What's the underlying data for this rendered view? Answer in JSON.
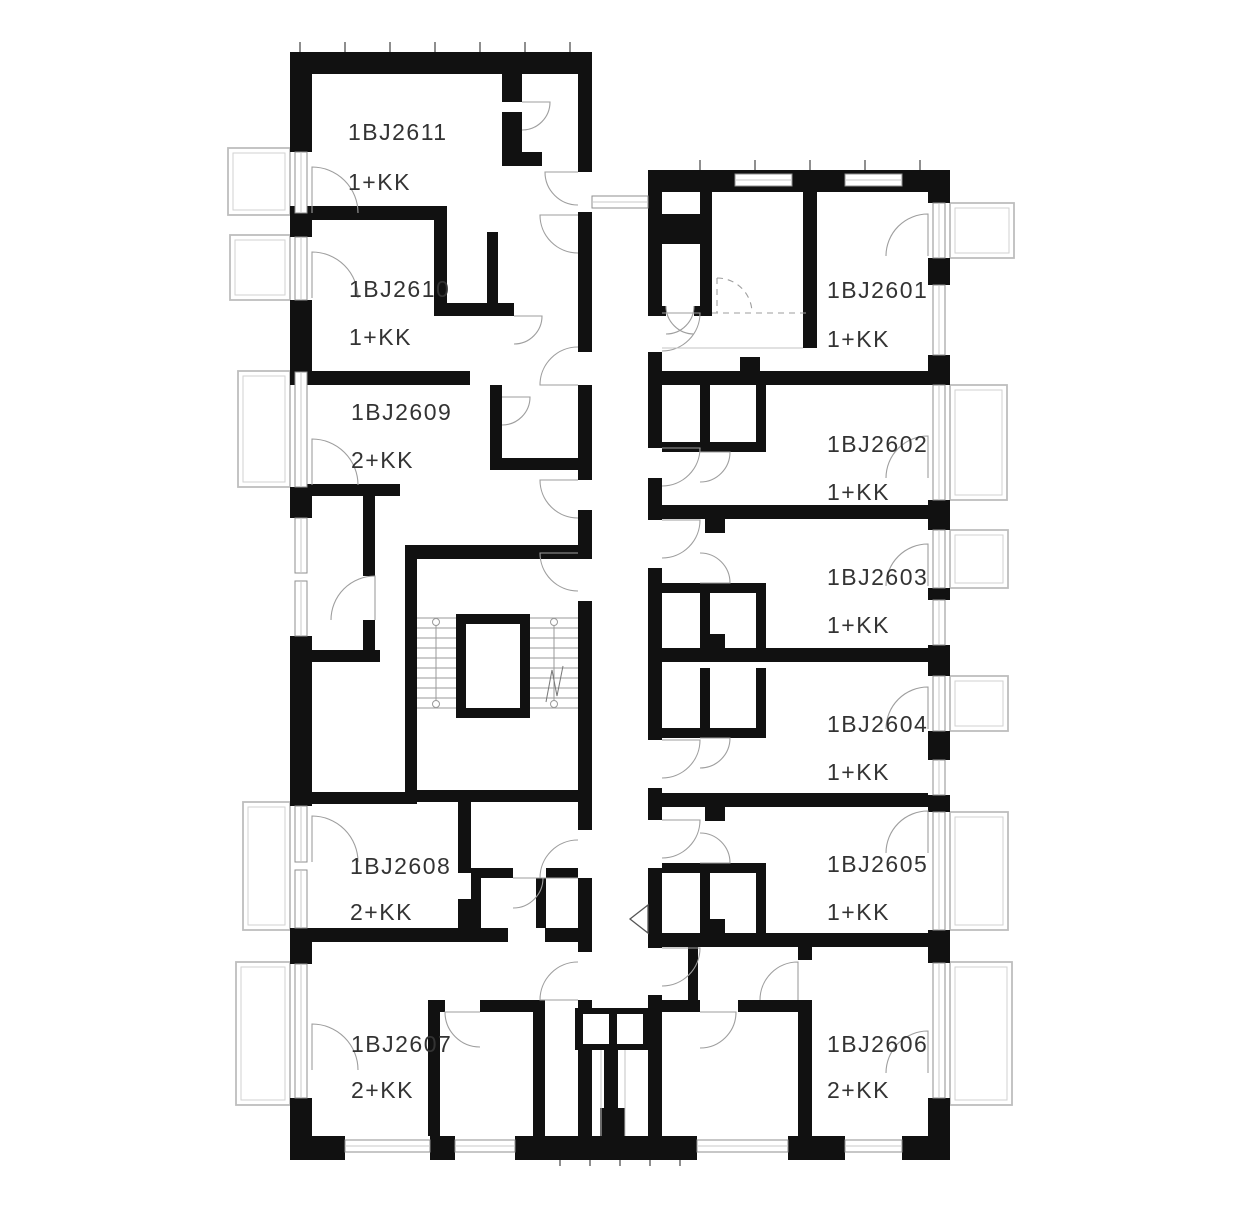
{
  "units": [
    {
      "id": "1BJ2611",
      "type": "1+KK"
    },
    {
      "id": "1BJ2610",
      "type": "1+KK"
    },
    {
      "id": "1BJ2609",
      "type": "2+KK"
    },
    {
      "id": "1BJ2608",
      "type": "2+KK"
    },
    {
      "id": "1BJ2607",
      "type": "2+KK"
    },
    {
      "id": "1BJ2601",
      "type": "1+KK"
    },
    {
      "id": "1BJ2602",
      "type": "1+KK"
    },
    {
      "id": "1BJ2603",
      "type": "1+KK"
    },
    {
      "id": "1BJ2604",
      "type": "1+KK"
    },
    {
      "id": "1BJ2605",
      "type": "1+KK"
    },
    {
      "id": "1BJ2606",
      "type": "2+KK"
    }
  ],
  "colors": {
    "wall": "#111111",
    "balcony_outline": "#bdbdbd",
    "door_arc": "#9e9e9e",
    "label_text": "#333333",
    "background": "#ffffff"
  }
}
